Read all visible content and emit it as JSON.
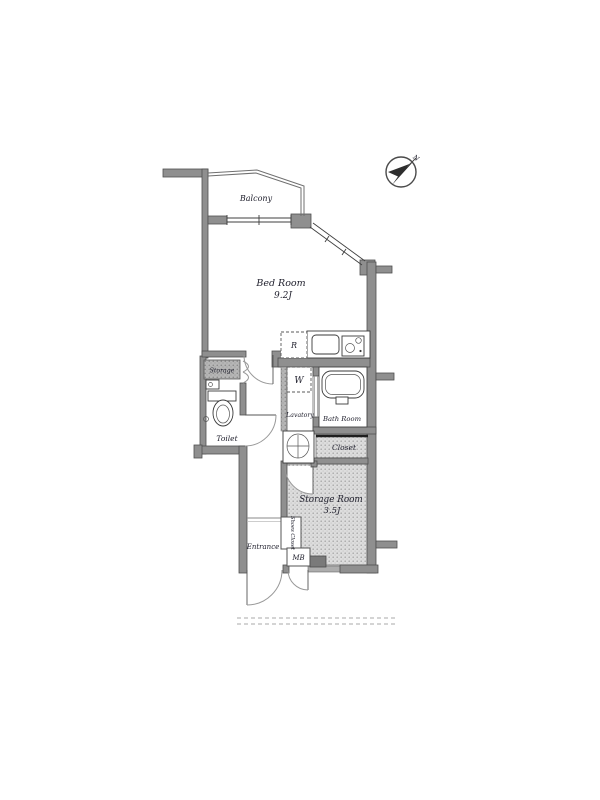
{
  "plan": {
    "type": "apartment-floor-plan",
    "colors": {
      "wall": "#8f8f8f",
      "wall_outline": "#4f4f4f",
      "shaded_floor": "#dcdcdc",
      "label_text": "#22222f",
      "background": "#ffffff"
    },
    "compass": {
      "label": "N",
      "direction": "northeast"
    },
    "labels": {
      "balcony": "Balcony",
      "bedroom_name": "Bed Room",
      "bedroom_size": "9.2J",
      "storage": "Storage",
      "toilet": "Toilet",
      "refrigerator": "R",
      "washing_machine": "W",
      "lavatory": "Lavatory",
      "bath_room": "Bath Room",
      "closet": "Closet",
      "storage_room_name": "Storage Room",
      "storage_room_size": "3.5J",
      "entrance": "Entrance",
      "shoes_closet": "Shoes Closet",
      "meter_box": "MB"
    }
  }
}
